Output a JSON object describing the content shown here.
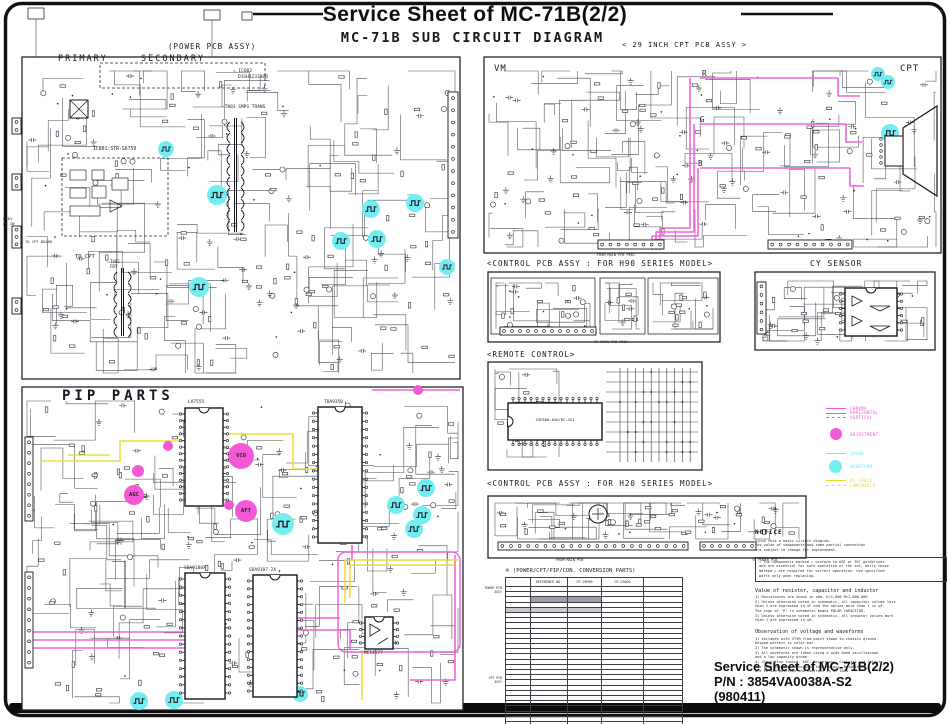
{
  "page": {
    "title": "Service Sheet of MC-71B(2/2)",
    "subtitle": "MC-71B SUB CIRCUIT DIAGRAM"
  },
  "power": {
    "label": "(POWER PCB ASSY)",
    "primary": "PRIMARY",
    "secondary": "SECONDARY",
    "ic802": "⚠ IC802",
    "ic802_part": "D1SH123200B",
    "t803": "⚠T803 SMPS TRANS",
    "ic801": "IC801:STR-S6759",
    "to_cpt_board": "TO CPT BOARD",
    "to_cpt": "TO CPT",
    "t402": "T402",
    "fbt": "FBT",
    "p801": "P801",
    "ac_in": "AC IN"
  },
  "cpt": {
    "label": "< 29 INCH CPT PCB ASSY >",
    "vm": "VM",
    "cpt": "CPT",
    "r": "R",
    "g": "G",
    "b": "B",
    "from_main": "FROM MAIN PCB P601"
  },
  "h90": {
    "label": "<CONTROL PCB ASSY : FOR H90 SERIES MODEL>",
    "to_main": "TO MAIN PCB P601"
  },
  "cy": {
    "label": "CY SENSOR"
  },
  "remote": {
    "label": "<REMOTE CONTROL>",
    "ic": "S3F880-05A/RC-2S1"
  },
  "pip": {
    "label": "PIP PARTS",
    "ic1": "LA7555",
    "ic2": "TDA9350",
    "ic3": "SDA9188X",
    "ic4": "SDA9187-2X",
    "ic5": "MC14577",
    "adj": [
      "VCO",
      "AGC",
      "AFT"
    ]
  },
  "h20": {
    "label": "<CONTROL PCB ASSY : FOR H20 SERIES MODEL>",
    "from_main": "FROM MAIN PCB",
    "to_power": "TO POWER PCB"
  },
  "table": {
    "title": "※ (POWER/CPT/PIP/CON. CONVERSION PARTS)",
    "headers": [
      "",
      "REFERENCE NO.",
      "CP-29H05",
      "CP-29Q05",
      ""
    ],
    "groups": [
      "POWER PCB ASSY",
      "CPT PCB ASSY"
    ]
  },
  "legend": {
    "items": [
      {
        "label": "CHROMA",
        "swatch": "line",
        "color": "#F25AD5",
        "dash": false
      },
      {
        "label": "HORIZONTAL",
        "swatch": "line",
        "color": "#F25AD5",
        "dash": false
      },
      {
        "label": "VERTICAL",
        "swatch": "line",
        "color": "#F25AD5",
        "dash": true
      },
      {
        "label": "ADJUSTMENT",
        "swatch": "circle",
        "color": "#F25AD5",
        "dash": false
      },
      {
        "label": "SOUND",
        "swatch": "line",
        "color": "#72EDF2",
        "dash": false
      },
      {
        "label": "WAVEFORM",
        "swatch": "circle",
        "color": "#72EDF2",
        "dash": false
      },
      {
        "label": "DC CABLE",
        "swatch": "line",
        "color": "#E8DC35",
        "dash": false
      },
      {
        "label": "LUMINANCE",
        "swatch": "line",
        "color": "#E8DC35",
        "dash": true
      }
    ]
  },
  "notice": {
    "title": "NOTICE",
    "intro": [
      "Since this a basic circuit diagram,",
      "the value of components and some partial connection",
      "are subject to change for improvement."
    ],
    "caution": [
      "⚠ The components marked ⚠ conform to ASE or IEC guidelines",
      "and are essential for safe operation of the set, while those",
      "marked ⚠ are required for correct operation. Use specified",
      "parts only when replacing."
    ],
    "value_title": "Value of resistor, capacitor and inductor",
    "value_lines": [
      "1) Resistances are shown in ohm.  K=1,000  M=1,000,000",
      "2) Unless otherwise noted in schematic, all capacitor values less",
      "   than 1 are expressed in uF and the values more than 1 in pF.",
      "   The sign of 'P' in schematic means POLAR CAPACITOR.",
      "3) Unless otherwise noted in schematic, all inductor values more",
      "   than 1 are expressed in uH."
    ],
    "obs_title": "Observation of voltage and waveforms",
    "obs_lines": [
      "1) Voltages with VTVM from point shown to chassis ground.",
      "   Keypad pattern is color-bar.",
      "2) The schematic shown is representative only.",
      "3) All waveforms are taken using a wide band oscilloscope",
      "   and a low capacity probe.",
      "4) Check fine tuning, AGC, Brightness, Contrast and Colour",
      "   for best picture. Make sure that Colour, Brightness",
      "   are in mid position and Contrast is at 100%."
    ]
  },
  "footer": {
    "line1": "Service Sheet of MC-71B(2/2)",
    "line2": "P/N : 3854VA0038A-S2",
    "line3": "(980411)"
  }
}
